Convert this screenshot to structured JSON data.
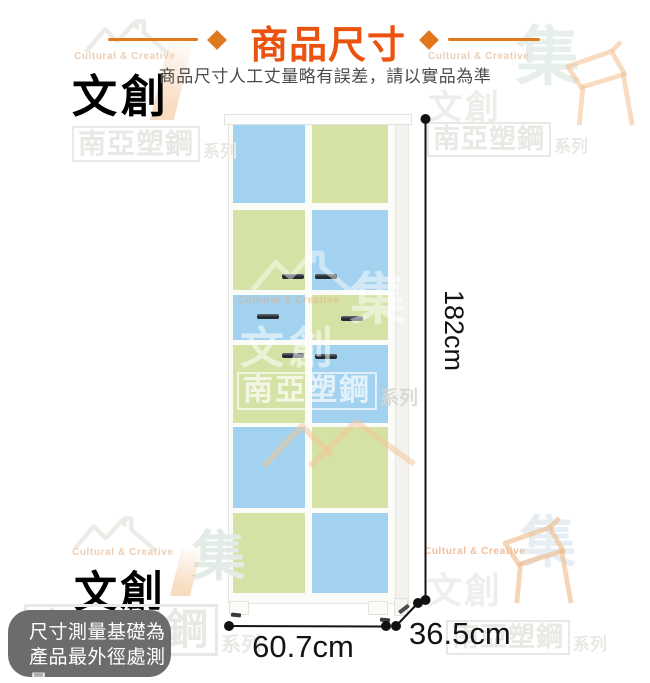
{
  "header": {
    "title": "商品尺寸",
    "subtitle": "商品尺寸人工丈量略有誤差，請以實品為準",
    "accent_color": "#ea520d",
    "ornament_color": "#e0781e"
  },
  "product_dimensions": {
    "height_label": "182cm",
    "width_label": "60.7cm",
    "depth_label": "36.5cm"
  },
  "note": {
    "line1": "尺寸測量基礎為",
    "line2": "產品最外徑處測量",
    "bg_color": "#6c6c6c",
    "text_color": "#ffffff"
  },
  "cabinet": {
    "panel_colors": {
      "blue": "#a2d2ef",
      "green": "#d5e2a5"
    },
    "rows": [
      [
        "blue",
        "green"
      ],
      [
        "green",
        "blue"
      ],
      [
        "blue",
        "green"
      ],
      [
        "green",
        "blue"
      ],
      [
        "blue",
        "green"
      ],
      [
        "green",
        "blue"
      ]
    ]
  },
  "watermark": {
    "brand_en": "Cultural & Creative",
    "brand_zh": "文創",
    "mark": "集",
    "series_brand": "南亞塑鋼",
    "series_suffix": "系列"
  }
}
